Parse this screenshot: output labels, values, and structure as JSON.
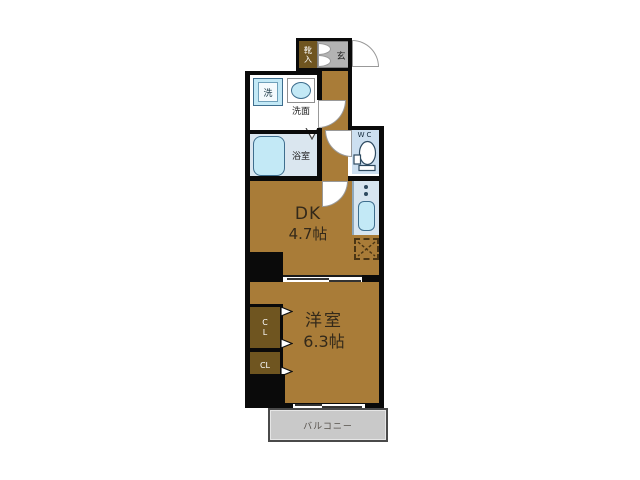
{
  "labels": {
    "shoe_cabinet": "靴入",
    "genkan": "玄",
    "washer": "洗",
    "basin": "洗面",
    "bathroom": "浴室",
    "wc": "WC",
    "dk_name": "DK",
    "dk_size": "4.7帖",
    "bedroom_name": "洋室",
    "bedroom_size": "6.3帖",
    "closet_upper": "CL",
    "closet_lower": "CL",
    "balcony": "バルコニー"
  },
  "colors": {
    "wall": "#0a0a0a",
    "floor_brown": "#A97C38",
    "closet_brown": "#6F5520",
    "entrance_gray": "#B3B3B3",
    "balcony_gray": "#C9C9C9",
    "water_blue": "#C3E9F6",
    "bath_floor": "#DAE6EF",
    "wc_floor": "#CCDFF0",
    "counter_blue": "#D7E5F0",
    "fixture_outline": "#3E6E8E",
    "label_dark": "#33291A"
  }
}
